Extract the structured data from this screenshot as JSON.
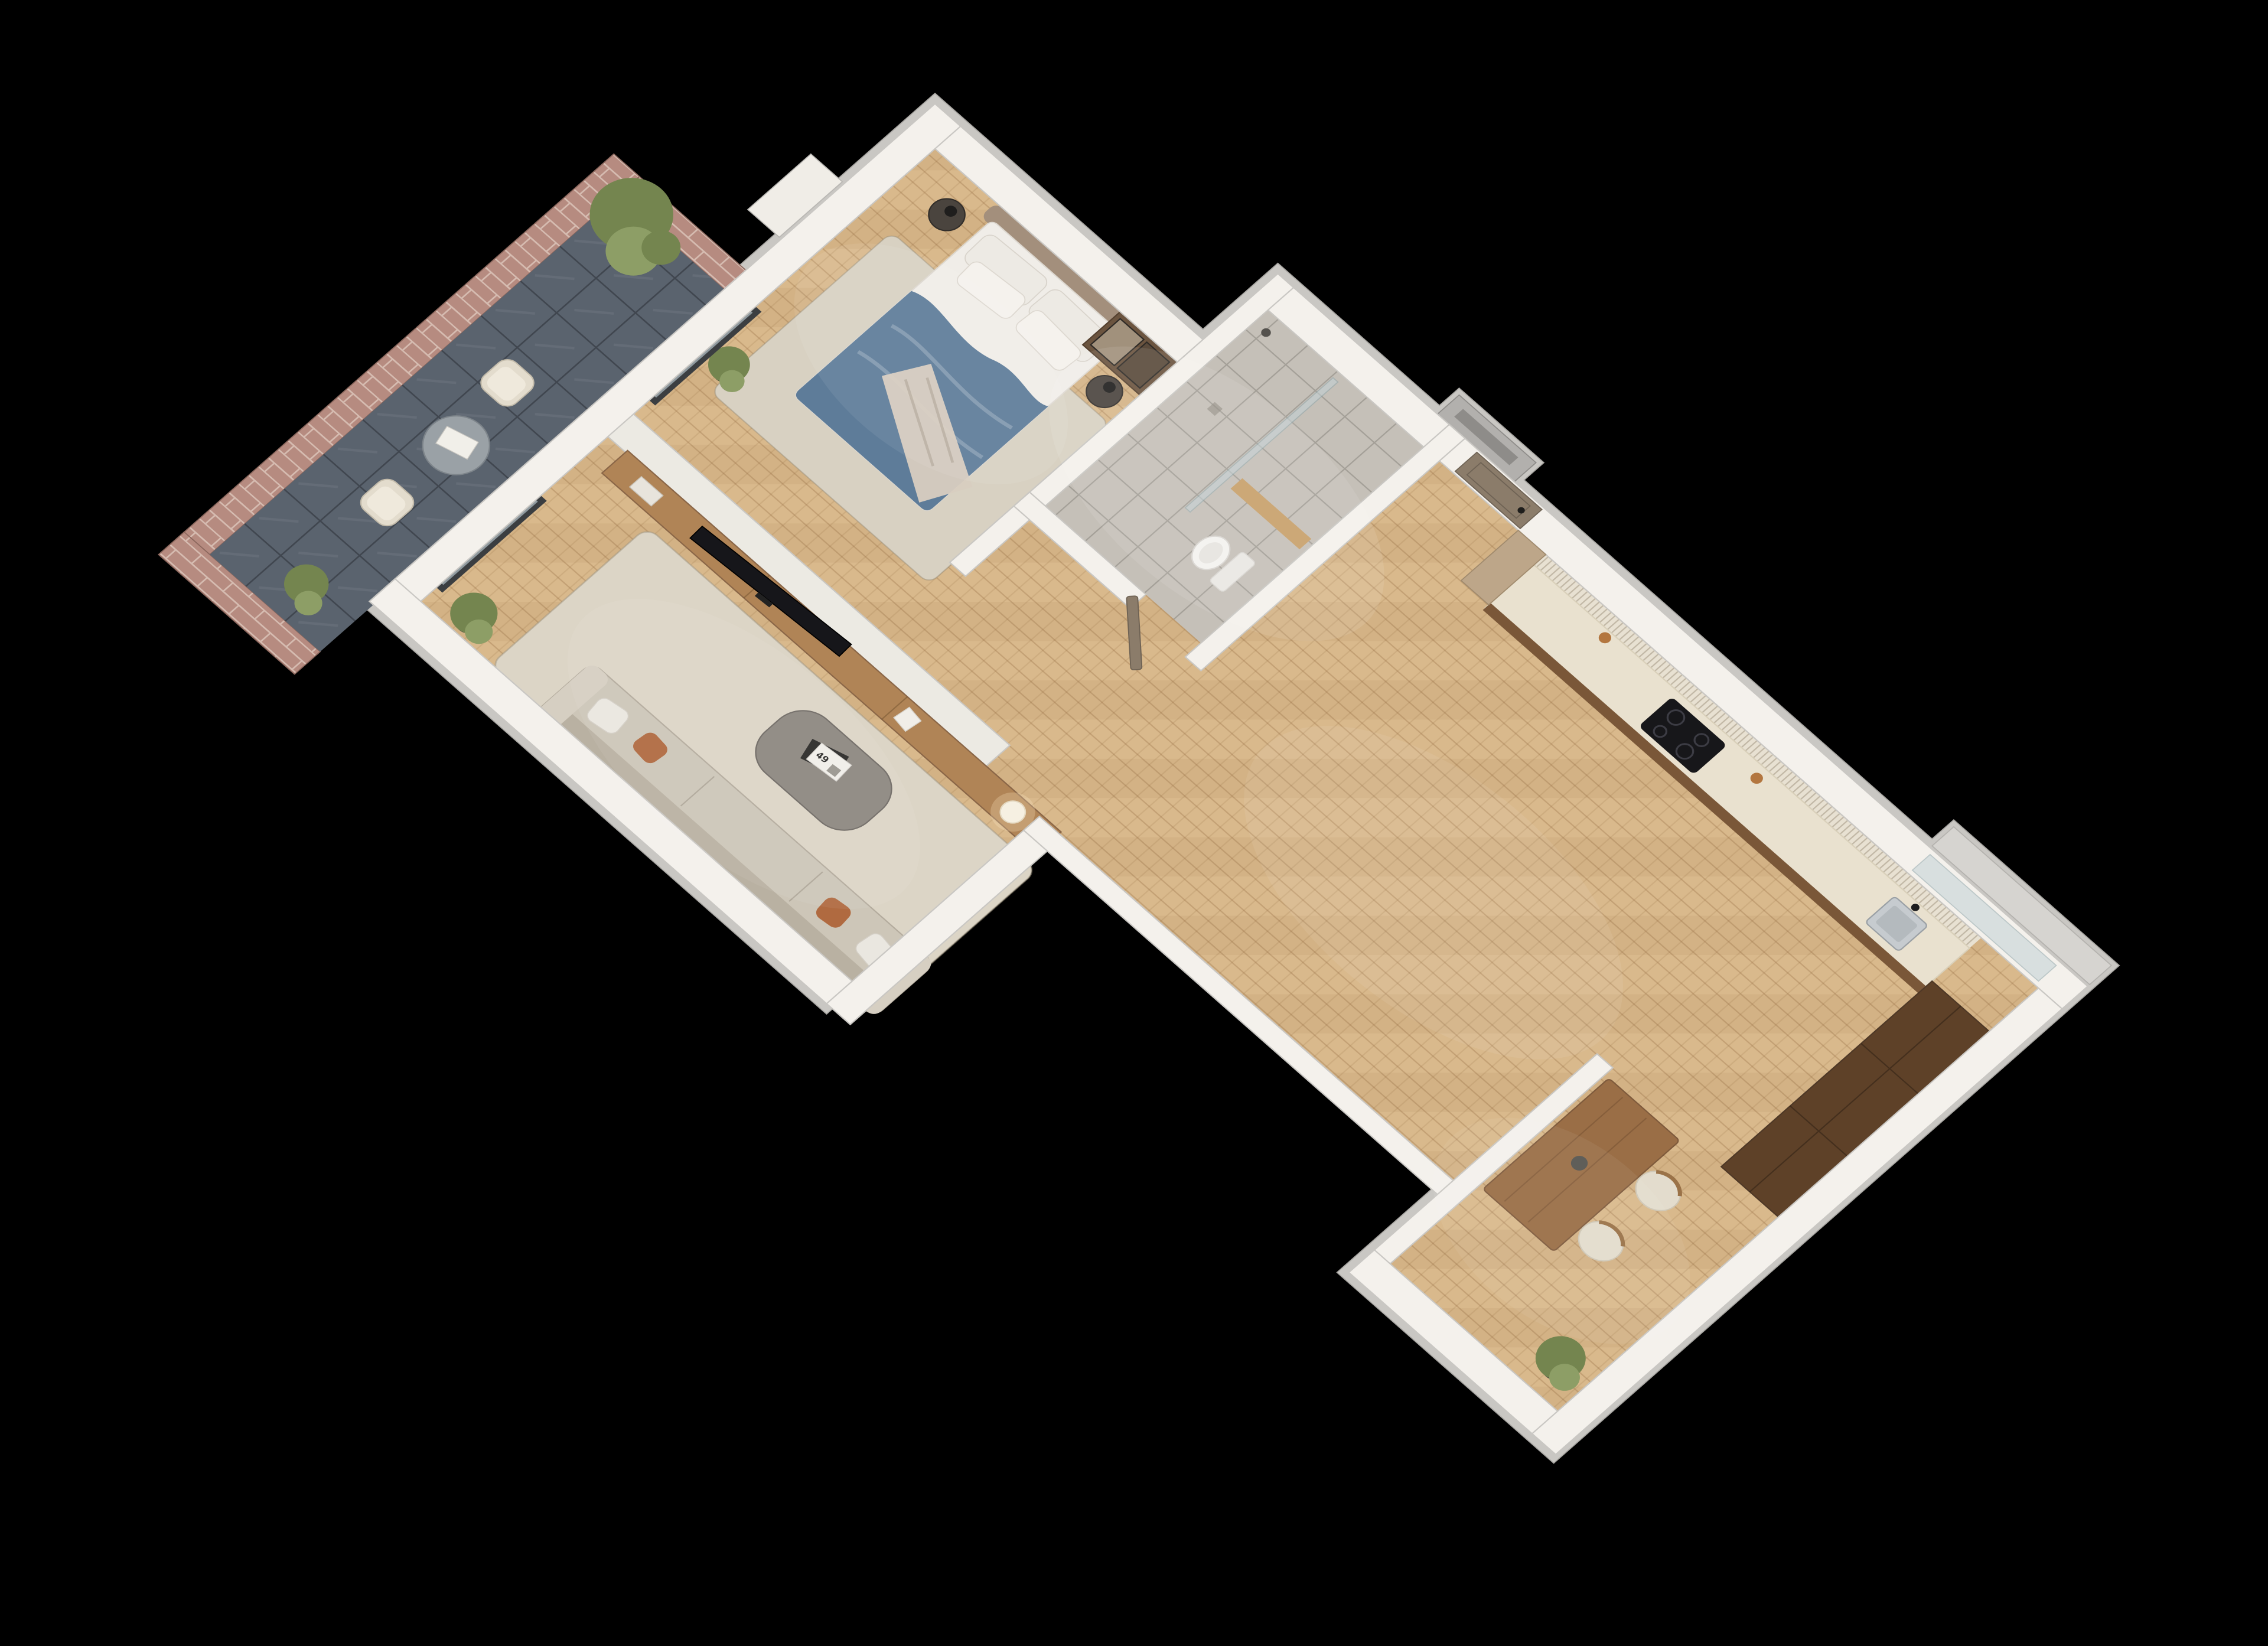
{
  "scene": {
    "type": "3d-axonometric-floorplan-render",
    "background": "#000000",
    "view": "top-down cutaway of a one-bedroom apartment",
    "magazine_label": "49"
  },
  "colors": {
    "bg": "#000000",
    "wall": "#f4f1ec",
    "wall_top": "#c9c7c3",
    "wall_stroke": "#a7a5a1",
    "shaft": "#b2b0ad",
    "floor_wood": "#d9b98c",
    "wood_grain": "#a87c4f",
    "bath_floor": "#c5c0b8",
    "grout": "#6f6a62",
    "slate": "#5a636e",
    "slate_line": "#2e343c",
    "brick": "#b68b80",
    "brick_mortar": "#d6bcb1",
    "walnut": "#7a5738",
    "walnut_dark": "#5e4128",
    "counter": "#e9e1cf",
    "slat": "#e8e1d2",
    "console": "#b08456",
    "table_wood": "#9a6e46",
    "door": "#8b7c6a",
    "frame_dark": "#3b3e41",
    "glass": "#c2d2d6",
    "sofa": "#cdc6b8",
    "sofa_back": "#b9b1a2",
    "sofa_arm": "#d6cfc2",
    "rug": "#dcd5c6",
    "rug_bed": "#d8d1c2",
    "coffee": "#8d8780",
    "tv": "#16161a",
    "duvet": "#5e7c99",
    "pillow": "#edeae4",
    "headboard": "#a38f7c",
    "throw": "#d8cec0",
    "terracotta": "#b06a40",
    "chair": "#e3dccd",
    "green": "#74854f",
    "green_light": "#8d9e66",
    "pot": "#3d3c39",
    "art_blue": "#2f5fa0",
    "art_bg": "#eef0f3",
    "art_frame": "#c49f66",
    "steel": "#c6cbcf",
    "lamp_warm": "#f6f0e2",
    "toilet": "#f3f2ef",
    "shelf_wood": "#c7a06a",
    "white_box": "#f0ede7",
    "column_wood": "#bda689",
    "newspaper": "#f1efe9",
    "balcony_table": "#9aa1a6"
  },
  "rooms": {
    "bedroom": {
      "items": [
        "artwork",
        "wardrobe",
        "headboard",
        "bed",
        "pillows",
        "duvet",
        "throw-blanket",
        "nightstand-left",
        "nightstand-right",
        "rug",
        "plant",
        "balcony-sliding-door"
      ]
    },
    "bathroom": {
      "items": [
        "shower-glass-partition",
        "wood-shelf",
        "wall-hung-toilet",
        "shower-head",
        "door"
      ]
    },
    "hallway": {
      "items": [
        "entry-door",
        "wood-column"
      ]
    },
    "kitchen": {
      "items": [
        "slatted-backsplash",
        "countertop",
        "induction-cooktop",
        "sink",
        "faucet",
        "tall-cabinets",
        "window-bay",
        "decor-jars"
      ]
    },
    "dining": {
      "items": [
        "partition",
        "wood-table",
        "vase",
        "chair-1",
        "chair-2",
        "plant"
      ]
    },
    "living": {
      "items": [
        "tv-half-wall",
        "tv-console",
        "tv",
        "sphere-lamp",
        "decor-box",
        "books",
        "rug",
        "coffee-table",
        "magazines",
        "sofa",
        "cushions",
        "plant",
        "balcony-sliding-door"
      ]
    },
    "balcony": {
      "items": [
        "brick-parapet",
        "slate-floor",
        "bistro-table",
        "newspaper",
        "chair-1",
        "chair-2",
        "plant-north",
        "plant-south",
        "tall-tree"
      ]
    },
    "exterior": {
      "items": [
        "vent-shaft",
        "window-sill-box",
        "wall-mounted-box"
      ]
    }
  }
}
